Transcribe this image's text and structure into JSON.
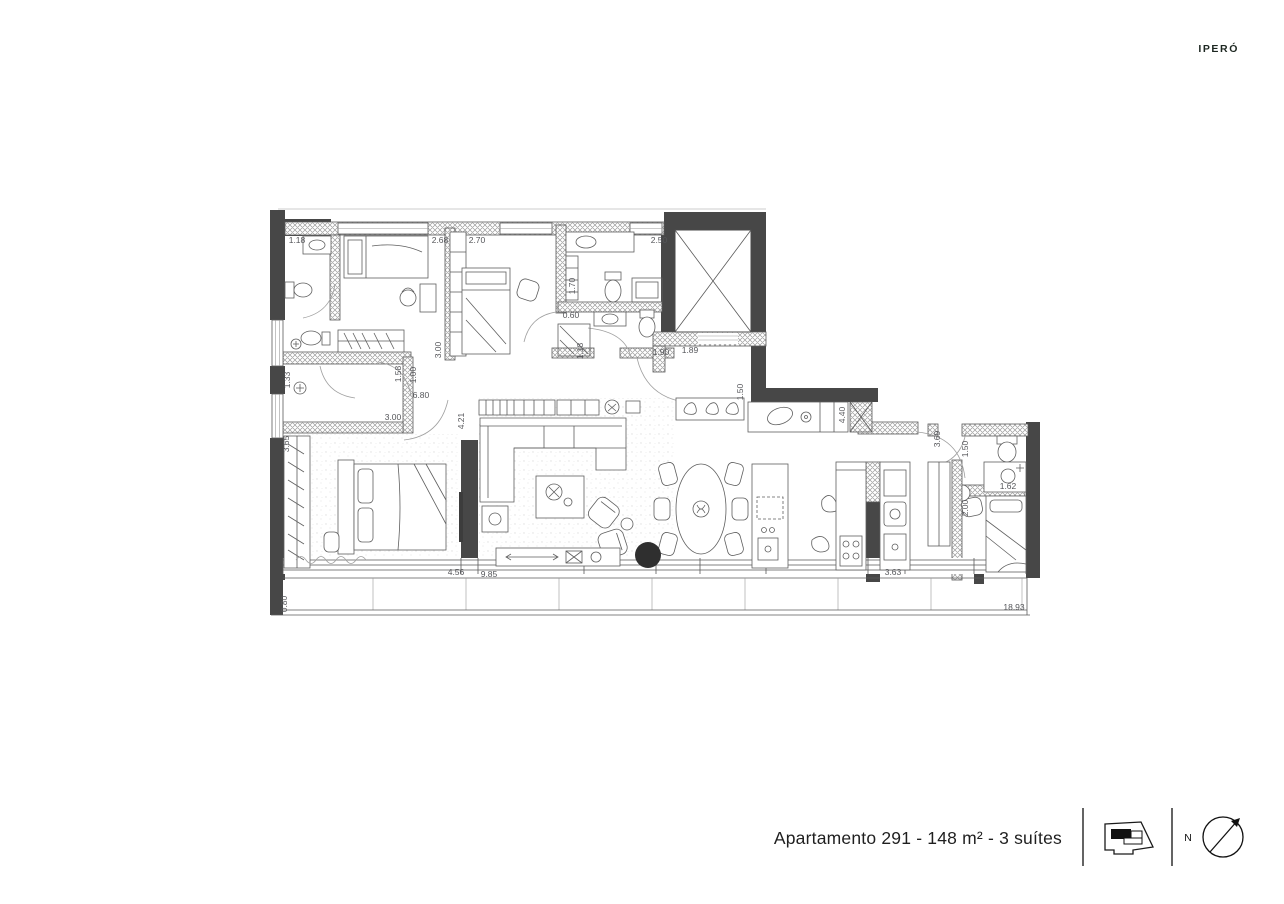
{
  "brand": "IPERÓ",
  "footer": {
    "caption": "Apartamento 291 - 148 m² - 3 suítes",
    "north_label": "N"
  },
  "colors": {
    "wall_dark": "#474747",
    "line": "#5a5a5a",
    "dim_text": "#55565a",
    "brand_text": "#1d2721"
  },
  "plan": {
    "dimensions": [
      {
        "label": "1.18",
        "x": 297,
        "y": 243,
        "rot": 0
      },
      {
        "label": "2.68",
        "x": 440,
        "y": 243,
        "rot": 0
      },
      {
        "label": "2.70",
        "x": 477,
        "y": 243,
        "rot": 0
      },
      {
        "label": "2.50",
        "x": 659,
        "y": 243,
        "rot": 0
      },
      {
        "label": "1.70",
        "x": 575,
        "y": 286,
        "rot": -90
      },
      {
        "label": "0.60",
        "x": 571,
        "y": 318,
        "rot": 0
      },
      {
        "label": "1.18",
        "x": 583,
        "y": 351,
        "rot": -90
      },
      {
        "label": "1.90",
        "x": 661,
        "y": 355,
        "rot": 0
      },
      {
        "label": "1.89",
        "x": 690,
        "y": 353,
        "rot": 0
      },
      {
        "label": "3.00",
        "x": 441,
        "y": 350,
        "rot": -90
      },
      {
        "label": "1.58",
        "x": 401,
        "y": 374,
        "rot": -90
      },
      {
        "label": "1.00",
        "x": 416,
        "y": 375,
        "rot": -90
      },
      {
        "label": "6.80",
        "x": 421,
        "y": 398,
        "rot": 0
      },
      {
        "label": "3.00",
        "x": 393,
        "y": 420,
        "rot": 0
      },
      {
        "label": "1.33",
        "x": 290,
        "y": 380,
        "rot": -90
      },
      {
        "label": "3.65",
        "x": 289,
        "y": 444,
        "rot": -90
      },
      {
        "label": "4.21",
        "x": 464,
        "y": 421,
        "rot": -90
      },
      {
        "label": "1.50",
        "x": 743,
        "y": 392,
        "rot": -90
      },
      {
        "label": "4.40",
        "x": 845,
        "y": 415,
        "rot": -90
      },
      {
        "label": "3.69",
        "x": 940,
        "y": 439,
        "rot": -90
      },
      {
        "label": "1.50",
        "x": 968,
        "y": 449,
        "rot": -90
      },
      {
        "label": "1.62",
        "x": 1008,
        "y": 489,
        "rot": 0
      },
      {
        "label": "2.00",
        "x": 968,
        "y": 508,
        "rot": -90
      },
      {
        "label": "3.63",
        "x": 893,
        "y": 575,
        "rot": 0
      },
      {
        "label": "4.56",
        "x": 456,
        "y": 575,
        "rot": 0
      },
      {
        "label": "9.85",
        "x": 489,
        "y": 577,
        "rot": 0
      },
      {
        "label": "0.80",
        "x": 287,
        "y": 604,
        "rot": -90
      },
      {
        "label": "18.93",
        "x": 1014,
        "y": 610,
        "rot": 0
      }
    ]
  }
}
